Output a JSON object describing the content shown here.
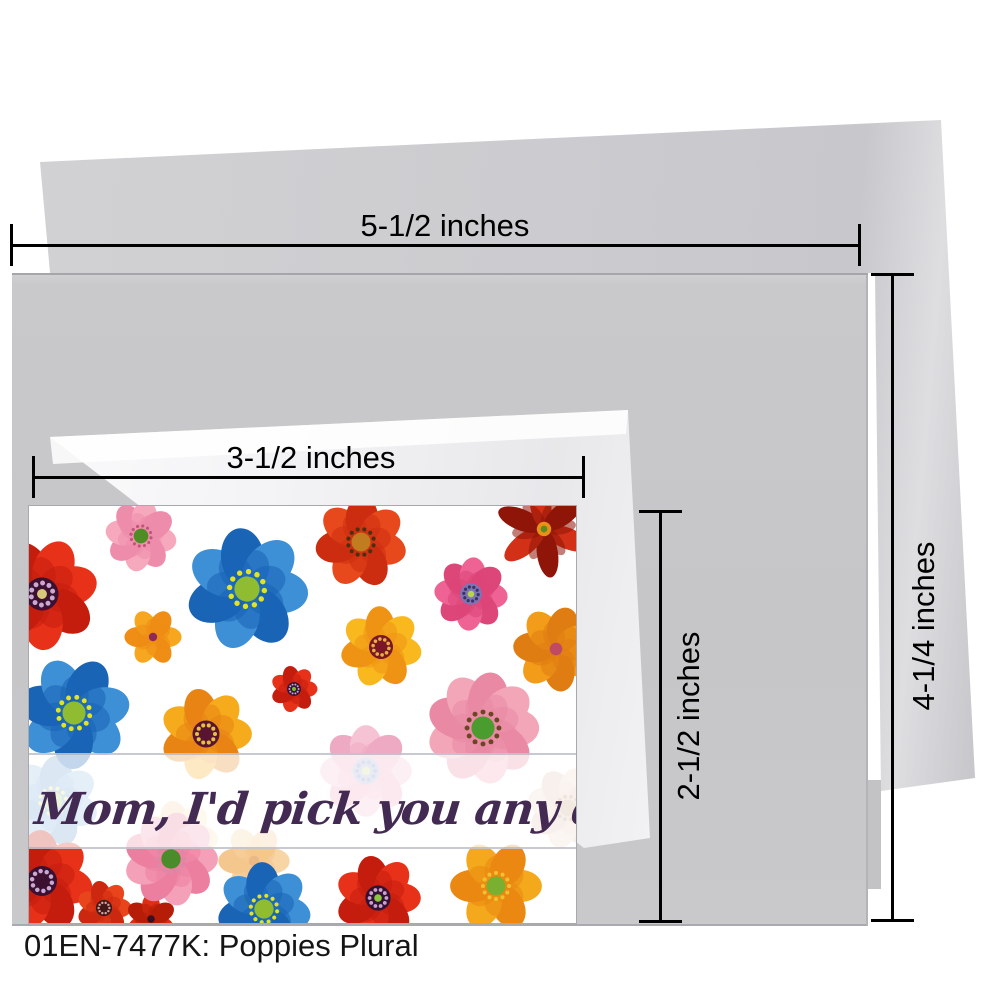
{
  "product": {
    "caption": "01EN-7477K: Poppies Plural",
    "card_message": "Mom, I'd pick you any day."
  },
  "dimensions": {
    "envelope_width": "5-1/2 inches",
    "card_width": "3-1/2 inches",
    "card_height": "2-1/2 inches",
    "envelope_height": "4-1/4 inches"
  },
  "colors": {
    "env_front": "#c6c6c8",
    "env_back": "#cdcdcf",
    "env_small": "#f2f2f4",
    "card_bg": "#ffffff",
    "dim_line": "#000000",
    "message_ink": "#432a52",
    "caption_ink": "#151515"
  },
  "flowers": [
    {
      "name": "faded-pink-poppy",
      "x": 337,
      "y": 265,
      "r": 45,
      "rot": 0,
      "n": 8,
      "c1": "#f5c0d2",
      "c2": "#eea6bf",
      "ct": "dark",
      "disc": "#a9b3d8",
      "dots": "#8089bd",
      "dot": "#cfe08c",
      "o": 0.95
    },
    {
      "name": "faded-blue-poppy",
      "x": 24,
      "y": 295,
      "r": 45,
      "rot": 20,
      "n": 7,
      "c1": "#7fb2df",
      "c2": "#528cc6",
      "ct": "ring",
      "disc": "#a9c95c",
      "dots": "#dbe262",
      "o": 0.8
    },
    {
      "name": "faded-yellow-poppy",
      "x": 150,
      "y": 333,
      "r": 38,
      "rot": 0,
      "n": 7,
      "c1": "#f8d9a2",
      "c2": "#f1c183",
      "ct": "ring",
      "disc": "#ece2d2",
      "dots": "#d2aa62",
      "o": 0.65
    },
    {
      "name": "faded-orange-poppy",
      "x": 225,
      "y": 355,
      "r": 35,
      "rot": 0,
      "n": 6,
      "c1": "#f5ba6b",
      "c2": "#eda244",
      "ct": "plain",
      "disc": "#e18a32",
      "o": 0.6
    },
    {
      "name": "beige-poppy",
      "x": 539,
      "y": 302,
      "r": 40,
      "rot": 15,
      "n": 8,
      "c1": "#edd5c6",
      "c2": "#e1bdaa",
      "ct": "ring",
      "disc": "#c29b79",
      "dots": "#a9815f",
      "o": 0.85
    },
    {
      "name": "red-poppy-top-left",
      "x": 13,
      "y": 88,
      "r": 55,
      "rot": -15,
      "n": 7,
      "c1": "#e73119",
      "c2": "#c41d0e",
      "ct": "dark",
      "disc": "#3c1030",
      "dots": "#c9a8d4",
      "dot": "#d8c87a"
    },
    {
      "name": "pink-poppy-top",
      "x": 112,
      "y": 30,
      "r": 35,
      "rot": 10,
      "n": 8,
      "c1": "#f6a8bd",
      "c2": "#ee8cab",
      "ct": "ring",
      "disc": "#4e8c24",
      "dots": "#c05578"
    },
    {
      "name": "blue-poppy-large",
      "x": 218,
      "y": 83,
      "r": 60,
      "rot": 5,
      "n": 7,
      "c1": "#3d8fd6",
      "c2": "#1a64b6",
      "ct": "ring",
      "disc": "#8fbc30",
      "dots": "#e3e322"
    },
    {
      "name": "red-orange-poppy-top",
      "x": 332,
      "y": 36,
      "r": 45,
      "rot": 15,
      "n": 7,
      "c1": "#e8491c",
      "c2": "#cc2d10",
      "ct": "ring",
      "disc": "#c07c1e",
      "dots": "#4a3010"
    },
    {
      "name": "magenta-poppy",
      "x": 442,
      "y": 88,
      "r": 36,
      "rot": 5,
      "n": 8,
      "c1": "#ee6394",
      "c2": "#dd4679",
      "ct": "dark",
      "disc": "#7d74b8",
      "dots": "#3a3560",
      "dot": "#b8d44a"
    },
    {
      "name": "crimson-star-poppy",
      "x": 515,
      "y": 23,
      "r": 48,
      "rot": 22,
      "n": 6,
      "star": true,
      "c1": "#d33018",
      "c2": "#8e1508",
      "ct": "plain",
      "disc": "#e89018",
      "dot": "#5a8c20"
    },
    {
      "name": "orange-poppy-small",
      "x": 124,
      "y": 131,
      "r": 28,
      "rot": 0,
      "n": 6,
      "c1": "#f6a71f",
      "c2": "#ef8d14",
      "ct": "plain",
      "disc": "#8e2a5a"
    },
    {
      "name": "golden-poppy",
      "x": 352,
      "y": 141,
      "r": 40,
      "rot": 10,
      "n": 7,
      "c1": "#f8b81e",
      "c2": "#ef9315",
      "ct": "dark",
      "disc": "#7a1626",
      "dots": "#e8b040"
    },
    {
      "name": "orange-poppy-right",
      "x": 527,
      "y": 143,
      "r": 42,
      "rot": 30,
      "n": 7,
      "c1": "#f29c1a",
      "c2": "#e07d12",
      "ct": "plain",
      "disc": "#c04a64"
    },
    {
      "name": "red-poppy-small",
      "x": 265,
      "y": 183,
      "r": 23,
      "rot": 0,
      "n": 7,
      "c1": "#e73119",
      "c2": "#c41d0e",
      "ct": "dark",
      "disc": "#2e1230",
      "dots": "#caa0d0",
      "dot": "#7ab82e"
    },
    {
      "name": "blue-poppy-left",
      "x": 45,
      "y": 207,
      "r": 55,
      "rot": 40,
      "n": 7,
      "c1": "#3d8fd6",
      "c2": "#1a64b6",
      "ct": "ring",
      "disc": "#8fbc30",
      "dots": "#e3e322"
    },
    {
      "name": "golden-poppy-left",
      "x": 177,
      "y": 228,
      "r": 45,
      "rot": 0,
      "n": 7,
      "c1": "#f6ab1c",
      "c2": "#e88414",
      "ct": "dark",
      "disc": "#581430",
      "dots": "#e8c040"
    },
    {
      "name": "pink-poppy-large",
      "x": 454,
      "y": 222,
      "r": 55,
      "rot": 0,
      "n": 9,
      "c1": "#f2a6b8",
      "c2": "#ea89a4",
      "ct": "ring",
      "disc": "#4a9c2e",
      "dots": "#6a4526"
    },
    {
      "name": "red-poppy-bottom-left",
      "x": 13,
      "y": 375,
      "r": 50,
      "rot": 10,
      "n": 7,
      "c1": "#e73119",
      "c2": "#c41d0e",
      "ct": "dark",
      "disc": "#3c1030",
      "dots": "#c9a8d4"
    },
    {
      "name": "red-poppy-small-bottom",
      "x": 75,
      "y": 402,
      "r": 27,
      "rot": 0,
      "n": 7,
      "c1": "#e8451c",
      "c2": "#cc2810",
      "ct": "dark",
      "disc": "#401818",
      "dots": "#d8a0a0"
    },
    {
      "name": "tiny-red-poppy",
      "x": 122,
      "y": 413,
      "r": 25,
      "rot": 30,
      "n": 6,
      "c1": "#dd2f14",
      "c2": "#b51d08",
      "ct": "plain",
      "disc": "#3a1020"
    },
    {
      "name": "pink-poppy-bottom",
      "x": 142,
      "y": 353,
      "r": 46,
      "rot": 0,
      "n": 9,
      "c1": "#f4a0b8",
      "c2": "#ec7fa0",
      "ct": "ring",
      "disc": "#4a8c2a",
      "dots": "#d98aa8"
    },
    {
      "name": "blue-poppy-bottom",
      "x": 235,
      "y": 403,
      "r": 46,
      "rot": 10,
      "n": 7,
      "c1": "#3d8fd6",
      "c2": "#1a64b6",
      "ct": "ring",
      "disc": "#8fbc30",
      "dots": "#e3e322"
    },
    {
      "name": "red-poppy-bottom",
      "x": 349,
      "y": 392,
      "r": 42,
      "rot": 0,
      "n": 7,
      "c1": "#e73119",
      "c2": "#c41d0e",
      "ct": "dark",
      "disc": "#331132",
      "dots": "#caa0d0",
      "dot": "#8bc53f"
    },
    {
      "name": "orange-poppy-bottom",
      "x": 467,
      "y": 380,
      "r": 45,
      "rot": 0,
      "n": 6,
      "c1": "#f4a81c",
      "c2": "#ea8812",
      "ct": "ring",
      "disc": "#7ab030",
      "dots": "#f0c030"
    }
  ]
}
